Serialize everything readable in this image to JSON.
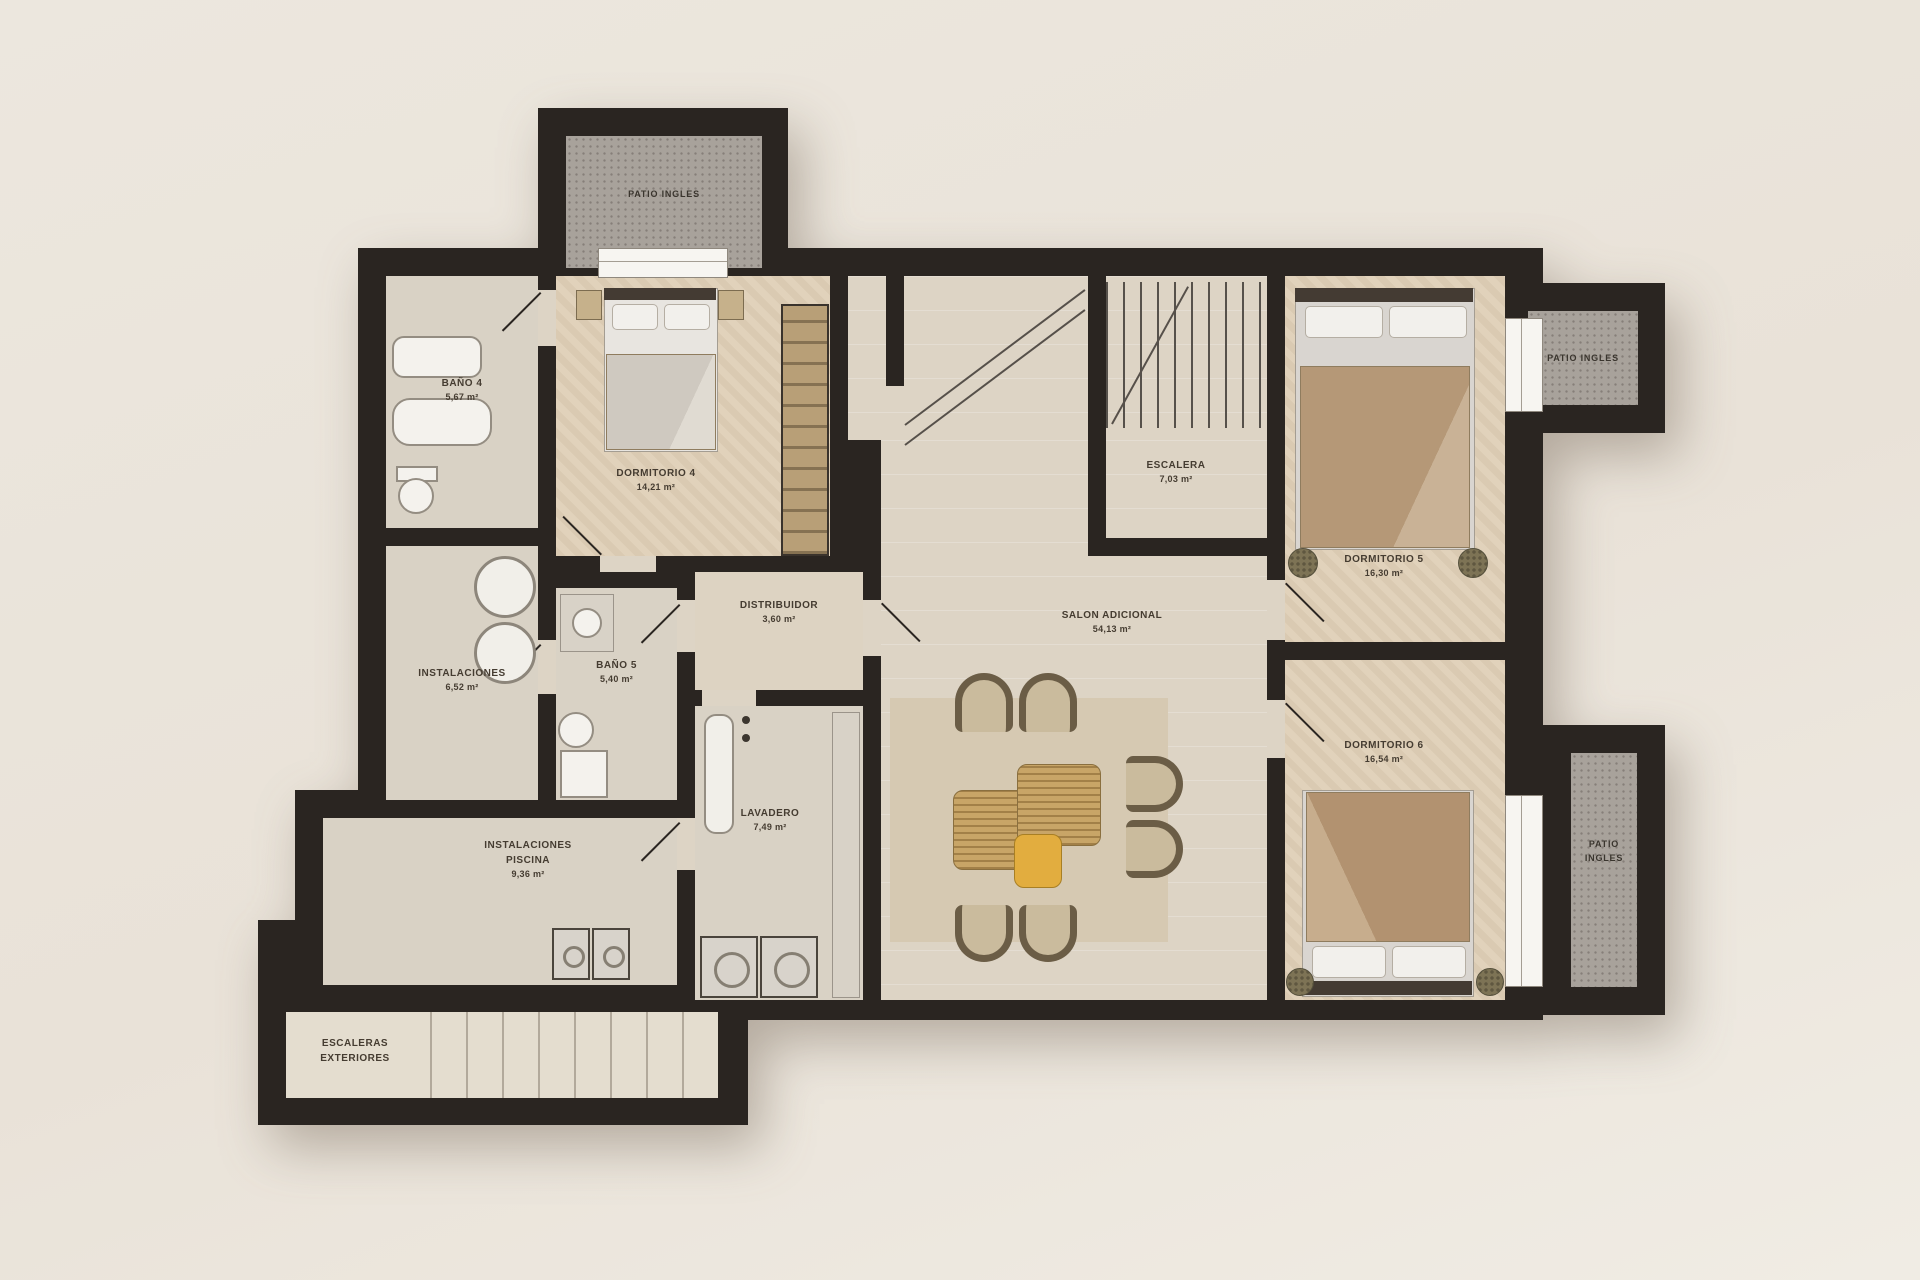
{
  "plan_title": "Floor plan - basement level",
  "rooms": {
    "patio_top": {
      "name": "PATIO INGLES"
    },
    "bano4": {
      "name": "BAÑO 4",
      "area": "5,67 m²"
    },
    "dorm4": {
      "name": "DORMITORIO 4",
      "area": "14,21 m²"
    },
    "escalera": {
      "name": "ESCALERA",
      "area": "7,03 m²"
    },
    "dorm5": {
      "name": "DORMITORIO 5",
      "area": "16,30 m²"
    },
    "patio_right": {
      "name": "PATIO INGLES"
    },
    "instalaciones": {
      "name": "INSTALACIONES",
      "area": "6,52 m²"
    },
    "bano5": {
      "name": "BAÑO 5",
      "area": "5,40 m²"
    },
    "distribuidor": {
      "name": "DISTRIBUIDOR",
      "area": "3,60 m²"
    },
    "salon": {
      "name": "SALON ADICIONAL",
      "area": "54,13 m²"
    },
    "dorm6": {
      "name": "DORMITORIO 6",
      "area": "16,54 m²"
    },
    "lavadero": {
      "name": "LAVADERO",
      "area": "7,49 m²"
    },
    "piscina": {
      "name": "INSTALACIONES",
      "name2": "PISCINA",
      "area": "9,36 m²"
    },
    "stairs_ext": {
      "name": "ESCALERAS",
      "name2": "EXTERIORES"
    },
    "patio_bottom": {
      "name": "PATIO",
      "name2": "INGLES"
    }
  },
  "colors": {
    "wall": "#2a2521",
    "floor": "#ddd4c5",
    "bedroom_floor": "#e1d2bb",
    "patio": "#a8a29b",
    "rug": "#d6c9b2",
    "rattan": "#c8a567",
    "pouf_accent": "#e2ad3f",
    "background": "#e9e2d8"
  }
}
